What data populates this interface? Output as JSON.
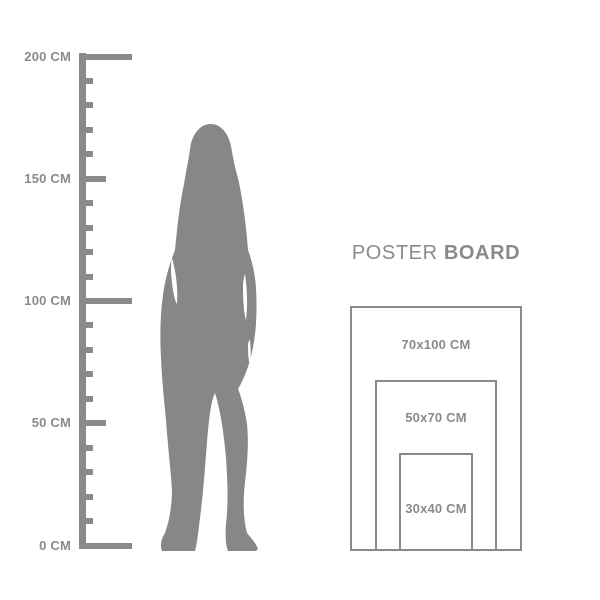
{
  "title": {
    "regular": "POSTER",
    "bold": "BOARD"
  },
  "ruler": {
    "unit": "CM",
    "max_cm": 200,
    "minor_step_cm": 10,
    "labeled_ticks": [
      {
        "cm": 200,
        "label": "200 CM"
      },
      {
        "cm": 150,
        "label": "150 CM"
      },
      {
        "cm": 100,
        "label": "100 CM"
      },
      {
        "cm": 50,
        "label": "50 CM"
      },
      {
        "cm": 0,
        "label": "0 CM"
      }
    ]
  },
  "figure": {
    "icon": "standing-woman-silhouette"
  },
  "poster_board": {
    "sizes": [
      {
        "label": "70x100 CM",
        "width_cm": 70,
        "height_cm": 100
      },
      {
        "label": "50x70 CM",
        "width_cm": 50,
        "height_cm": 70
      },
      {
        "label": "30x40 CM",
        "width_cm": 30,
        "height_cm": 40
      }
    ]
  },
  "colors": {
    "gray": "#8a8a8a",
    "silhouette": "#878787",
    "background": "#ffffff"
  }
}
